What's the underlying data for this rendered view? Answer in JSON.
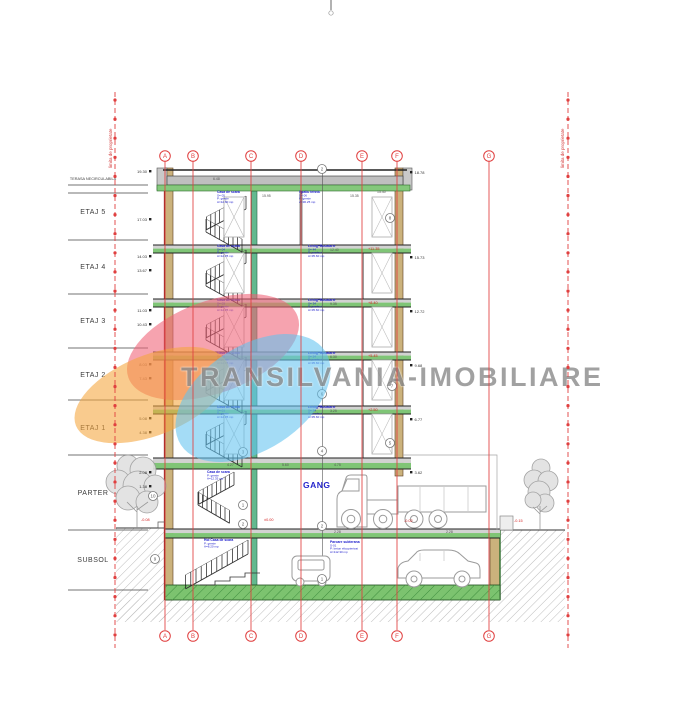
{
  "page": {
    "background": "#ffffff"
  },
  "watermark": {
    "text": "TRANSILVANIA-IMOBILIARE",
    "color": "#8a8a8a"
  },
  "logo": {
    "blobs": [
      {
        "name": "pink-blob",
        "color": "#ef6176"
      },
      {
        "name": "orange-blob",
        "color": "#f4a53d"
      },
      {
        "name": "blue-blob",
        "color": "#63c3ef"
      }
    ]
  },
  "gang_label": "GANG",
  "floor_labels": [
    {
      "label": "TERASA NECIRCULABILA",
      "y": 178,
      "small": true
    },
    {
      "label": "ETAJ 5",
      "y": 212
    },
    {
      "label": "ETAJ 4",
      "y": 267
    },
    {
      "label": "ETAJ 3",
      "y": 321
    },
    {
      "label": "ETAJ 2",
      "y": 375
    },
    {
      "label": "ETAJ 1",
      "y": 428
    },
    {
      "label": "PARTER",
      "y": 493
    },
    {
      "label": "SUBSOL",
      "y": 560
    }
  ],
  "grid": {
    "columns": [
      {
        "label": "A",
        "x": 165
      },
      {
        "label": "B",
        "x": 193
      },
      {
        "label": "C",
        "x": 251
      },
      {
        "label": "D",
        "x": 301
      },
      {
        "label": "E",
        "x": 362
      },
      {
        "label": "F",
        "x": 397
      },
      {
        "label": "G",
        "x": 489
      }
    ],
    "top_y": 156,
    "bottom_y": 636
  },
  "property_lines": {
    "left": {
      "x": 115,
      "label": "limita de proprietate"
    },
    "right": {
      "x": 568,
      "label": "limita de proprietate"
    }
  },
  "rooms": [
    {
      "x": 217,
      "y": 193,
      "lines": [
        "Casa de scara",
        "S= 05",
        "P: gresie",
        "A=12.60 mp"
      ]
    },
    {
      "x": 299,
      "y": 193,
      "lines": [
        "Spatiu tehnic",
        "S= 06",
        "P: gresie",
        "A=30.25 mp"
      ]
    },
    {
      "x": 217,
      "y": 247,
      "lines": [
        "Casa de scara",
        "S= 04",
        "P: gresie",
        "A=12.35 mp"
      ]
    },
    {
      "x": 308,
      "y": 247,
      "lines": [
        "Living+Bucatarie",
        "S= 44",
        "P: parchet",
        "A=35.60 mp"
      ]
    },
    {
      "x": 217,
      "y": 301,
      "lines": [
        "Casa de scara",
        "S= 03",
        "P: gresie",
        "A=12.35 mp"
      ]
    },
    {
      "x": 308,
      "y": 301,
      "lines": [
        "Living+Bucatarie",
        "S= 34",
        "P: parchet",
        "A=35.60 mp"
      ]
    },
    {
      "x": 217,
      "y": 354,
      "lines": [
        "Casa de scara",
        "S= 02",
        "P: gresie",
        "A=12.35 mp"
      ]
    },
    {
      "x": 308,
      "y": 354,
      "lines": [
        "Living+Bucatarie",
        "S= 24",
        "P: parchet",
        "A=35.60 mp"
      ]
    },
    {
      "x": 217,
      "y": 408,
      "lines": [
        "Casa de scara",
        "S= 01",
        "P: gresie",
        "A=12.35 mp"
      ]
    },
    {
      "x": 308,
      "y": 408,
      "lines": [
        "Living+Bucatarie",
        "S= 14",
        "P: parchet",
        "A=35.60 mp"
      ]
    },
    {
      "x": 207,
      "y": 473,
      "lines": [
        "Casa de scara",
        "P: gresie",
        "A=12.35 mp"
      ]
    },
    {
      "x": 204,
      "y": 541,
      "lines": [
        "Hol Casa de scara",
        "P: gresie",
        "A=8.20 mp"
      ]
    },
    {
      "x": 330,
      "y": 543,
      "lines": [
        "Parcare subterana",
        "S-01",
        "P: beton elicopterizat",
        "A=112.30 mp"
      ]
    }
  ],
  "elevations": {
    "left": [
      {
        "y": 172,
        "text": "19.30"
      },
      {
        "y": 220,
        "text": "17.03"
      },
      {
        "y": 257,
        "text": "14.03"
      },
      {
        "y": 271,
        "text": "13.67"
      },
      {
        "y": 311,
        "text": "11.03"
      },
      {
        "y": 325,
        "text": "10.43"
      },
      {
        "y": 365,
        "text": "8.03"
      },
      {
        "y": 379,
        "text": "7.43"
      },
      {
        "y": 419,
        "text": "5.08"
      },
      {
        "y": 433,
        "text": "4.38"
      },
      {
        "y": 473,
        "text": "2.08"
      },
      {
        "y": 487,
        "text": "1.38"
      }
    ],
    "right": [
      {
        "y": 173,
        "text": "18.78"
      },
      {
        "y": 258,
        "text": "15.73"
      },
      {
        "y": 312,
        "text": "12.72"
      },
      {
        "y": 366,
        "text": "9.68"
      },
      {
        "y": 420,
        "text": "6.77"
      },
      {
        "y": 473,
        "text": "3.62"
      }
    ]
  },
  "levels_red": [
    {
      "x": 264,
      "y": 521,
      "text": "±0.00"
    },
    {
      "x": 404,
      "y": 522,
      "text": "-0.02"
    },
    {
      "x": 514,
      "y": 522,
      "text": "-0.15"
    },
    {
      "x": 141,
      "y": 521,
      "text": "-0.08"
    },
    {
      "x": 368,
      "y": 250,
      "text": "+11.35"
    },
    {
      "x": 368,
      "y": 304,
      "text": "+8.40"
    },
    {
      "x": 368,
      "y": 357,
      "text": "+5.45"
    },
    {
      "x": 368,
      "y": 411,
      "text": "+2.50"
    }
  ],
  "dims": [
    {
      "x": 262,
      "y": 197,
      "text": "15.95"
    },
    {
      "x": 350,
      "y": 197,
      "text": "15.35"
    },
    {
      "x": 377,
      "y": 193,
      "text": "15.40"
    },
    {
      "x": 213,
      "y": 180,
      "text": "6.48"
    },
    {
      "x": 330,
      "y": 251,
      "text": "12.40"
    },
    {
      "x": 330,
      "y": 305,
      "text": "9.35"
    },
    {
      "x": 330,
      "y": 358,
      "text": "6.30"
    },
    {
      "x": 330,
      "y": 412,
      "text": "3.25"
    },
    {
      "x": 282,
      "y": 466,
      "text": "5.60"
    },
    {
      "x": 334,
      "y": 466,
      "text": "4.75"
    },
    {
      "x": 227,
      "y": 466,
      "text": "4.27"
    },
    {
      "x": 334,
      "y": 533,
      "text": "2.28"
    },
    {
      "x": 446,
      "y": 533,
      "text": "2.28"
    }
  ],
  "detail_markers": [
    {
      "x": 322,
      "y": 169,
      "n": "2"
    },
    {
      "x": 390,
      "y": 218,
      "n": "8"
    },
    {
      "x": 392,
      "y": 386,
      "n": "7"
    },
    {
      "x": 390,
      "y": 443,
      "n": "5"
    },
    {
      "x": 322,
      "y": 394,
      "n": "6"
    },
    {
      "x": 322,
      "y": 451,
      "n": "4"
    },
    {
      "x": 322,
      "y": 526,
      "n": "2"
    },
    {
      "x": 322,
      "y": 579,
      "n": "1"
    },
    {
      "x": 243,
      "y": 452,
      "n": "3"
    },
    {
      "x": 243,
      "y": 505,
      "n": "1"
    },
    {
      "x": 243,
      "y": 524,
      "n": "2"
    },
    {
      "x": 153,
      "y": 496,
      "n": "10"
    },
    {
      "x": 155,
      "y": 559,
      "n": "9"
    }
  ],
  "colors": {
    "grid_red": "#e04040",
    "slab_green": "#7fc576",
    "wall_tan": "#cbb27c",
    "label_blue": "#2020cc",
    "red_text": "#d43c3c"
  }
}
